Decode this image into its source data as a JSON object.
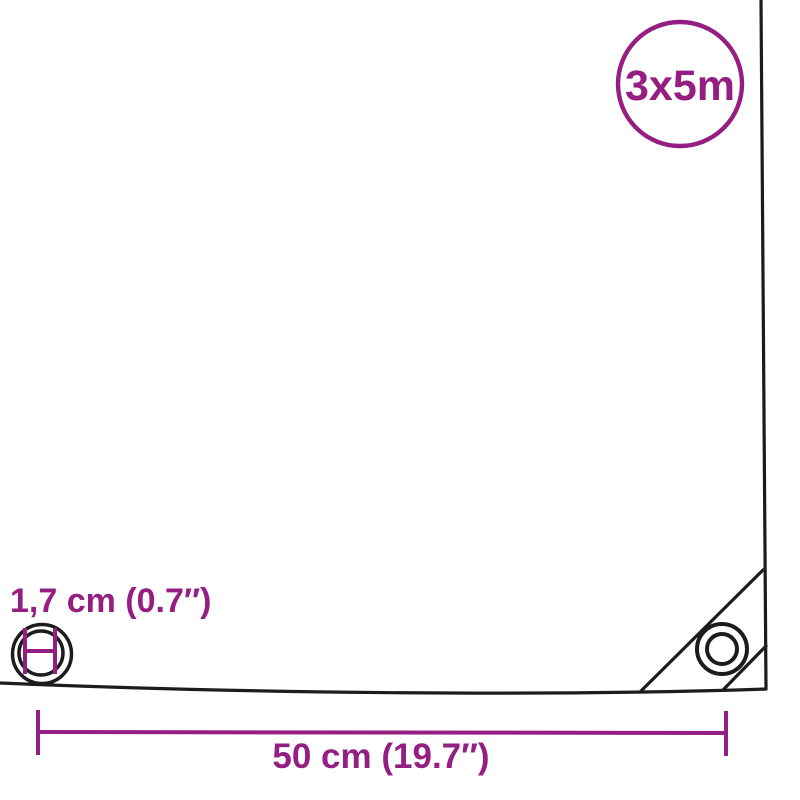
{
  "colors": {
    "accent": "#941e82",
    "line": "#1c1c1c",
    "background": "#ffffff"
  },
  "badge": {
    "size_label": "3x5m"
  },
  "eyelet": {
    "diameter_label": "1,7 cm (0.7″)"
  },
  "dimension": {
    "distance_label": "50 cm (19.7″)"
  }
}
